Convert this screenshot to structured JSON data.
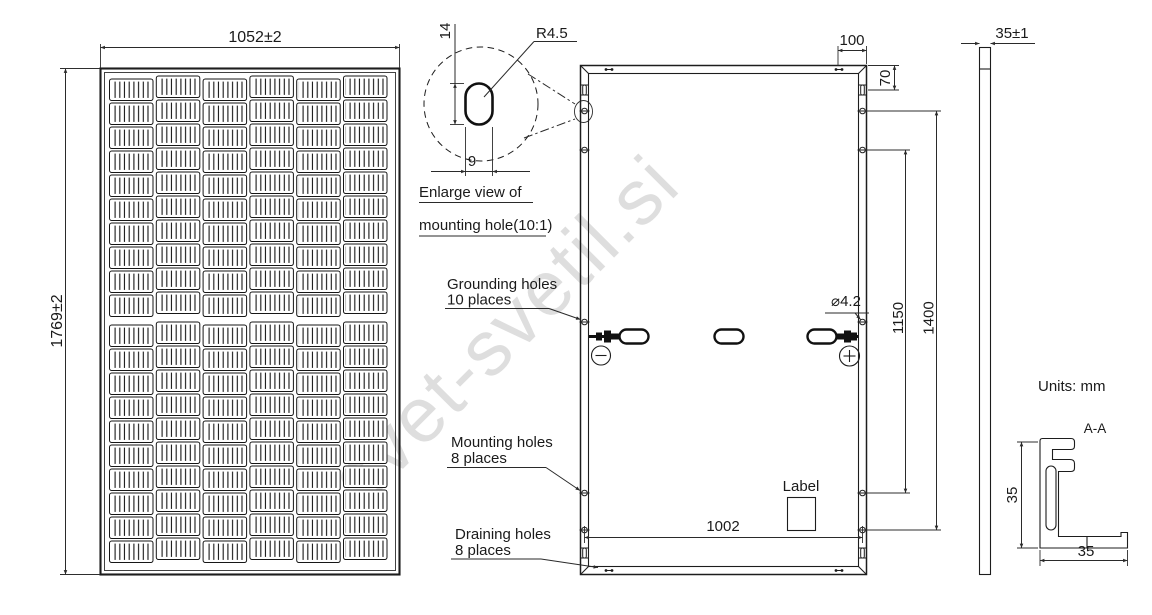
{
  "watermark": "svet-svetil.si",
  "front_view": {
    "width_dim": "1052±2",
    "height_dim": "1769±2",
    "columns": 6,
    "rows": 20
  },
  "detail_view": {
    "radius_label": "R4.5",
    "height_dim": "14",
    "width_dim": "9",
    "caption_line1": "Enlarge view of",
    "caption_line2": "mounting hole(10:1)"
  },
  "back_view": {
    "top_offset_dim": "100",
    "corner_offset_dim": "70",
    "inner_hole_span_dim": "1150",
    "outer_hole_span_dim": "1400",
    "bottom_hole_span_dim": "1002",
    "grounding_hole_dia": "⌀4.2",
    "label_text": "Label",
    "polarity_negative": "−",
    "polarity_positive": "+",
    "callouts": [
      {
        "line1": "Grounding holes",
        "line2": "10 places"
      },
      {
        "line1": "Mounting holes",
        "line2": "8 places"
      },
      {
        "line1": "Draining holes",
        "line2": "8 places"
      }
    ]
  },
  "side_view": {
    "thickness_dim": "35±1"
  },
  "section_view": {
    "title": "A-A",
    "units_label": "Units: mm",
    "height_dim": "35",
    "width_dim": "35"
  }
}
